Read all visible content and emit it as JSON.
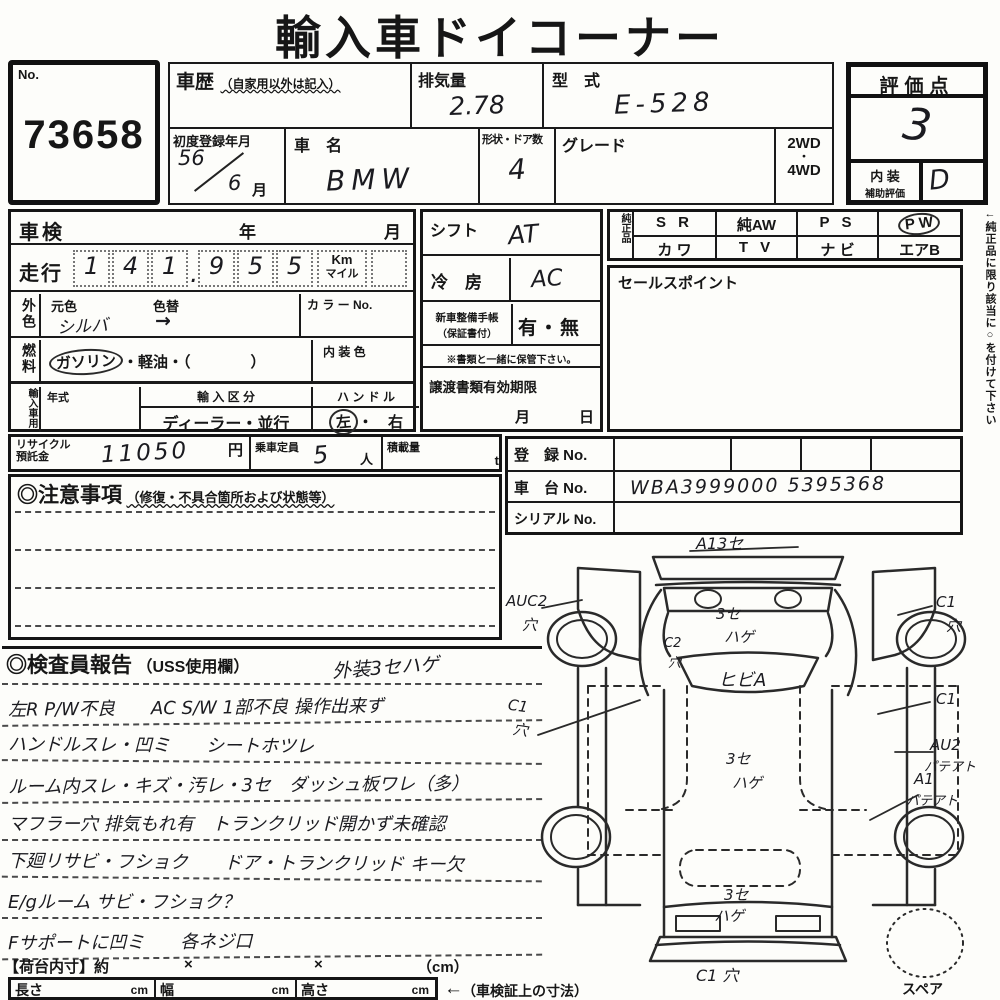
{
  "title": "輸入車ドイコーナー",
  "lot": {
    "label": "No.",
    "number": "73658"
  },
  "header": {
    "history_label": "車歴",
    "history_note": "（自家用以外は記入）",
    "displacement_label": "排気量",
    "displacement_value": "2.78",
    "model_label": "型　式",
    "model_value": "E-528",
    "first_reg_label": "初度登録年月",
    "first_reg_year": "56",
    "first_reg_month": "6",
    "first_reg_month_unit": "月",
    "make_label": "車　名",
    "make_value": "BMW",
    "body_doors_label": "形状・ドア数",
    "body_doors_value": "4",
    "grade_label": "グレード",
    "drive_top": "2WD",
    "drive_mid": "・",
    "drive_bottom": "4WD"
  },
  "rating": {
    "label": "評価点",
    "score": "3",
    "interior_line1": "内 装",
    "interior_line2": "補助評価",
    "interior_grade": "D"
  },
  "inspection": {
    "shaken_label": "車検",
    "year_label": "年",
    "month_label": "月",
    "mileage_label": "走行",
    "mileage_digits": [
      "1",
      "4",
      "1",
      "9",
      "5",
      "5"
    ],
    "mileage_point": ".",
    "unit_km": "Km",
    "unit_mile": "マイル",
    "ext_color_side": "外色",
    "orig_color_label": "元色",
    "color_change_label": "色替",
    "orig_color_value": "シルバ",
    "color_change_value": "→",
    "color_no_label": "カ ラ ー No.",
    "fuel_side": "燃料",
    "fuel_circled": "ガソリン",
    "fuel_rest": "・軽油・（　　　　）",
    "interior_color_label": "内 装 色"
  },
  "import_block": {
    "side_label": "輸入車用",
    "year_type_label": "年式",
    "class_label": "輸 入 区 分",
    "class_value": "ディーラー・並行",
    "handle_label": "ハ ン ド ル",
    "handle_left": "左",
    "handle_rest": "・　右"
  },
  "mid_block": {
    "shift_label": "シフト",
    "shift_value": "AT",
    "ac_label": "冷　房",
    "ac_value": "AC",
    "book_label1": "新車整備手帳",
    "book_label2": "（保証書付）",
    "book_value": "有・無",
    "book_note": "※書類と一緒に保管下さい。",
    "transfer_label": "譲渡書類有効期限",
    "transfer_month": "月",
    "transfer_day": "日"
  },
  "parts": {
    "side_label": "純正品",
    "row1": [
      "S R",
      "純AW",
      "P S",
      "P W"
    ],
    "row2": [
      "カ ワ",
      "T V",
      "ナ ビ",
      "エアB"
    ]
  },
  "sales": {
    "label": "セールスポイント"
  },
  "side_note": "←純正品に限り該当に○を付けて下さい",
  "recycle": {
    "label1": "リサイクル",
    "label2": "預託金",
    "value": "11050",
    "unit": "円",
    "capacity_label": "乗車定員",
    "capacity_value": "5",
    "capacity_unit": "人",
    "load_label": "積載量",
    "load_unit": "t"
  },
  "registration": {
    "reg_label": "登　録 No.",
    "chassis_label": "車　台 No.",
    "chassis_value": "WBA3999000 5395368",
    "serial_label": "シリアル No."
  },
  "cautions": {
    "title": "◎注意事項",
    "subtitle": "（修復・不具合箇所および状態等）"
  },
  "report": {
    "title": "◎検査員報告",
    "subtitle": "（USS使用欄）",
    "note": "外装3セハゲ",
    "lines": [
      "左R P/W不良　　AC S/W 1部不良 操作出来ず",
      "ハンドルスレ・凹ミ　　シートホツレ",
      "ルーム内スレ・キズ・汚レ・3セ　ダッシュ板ワレ（多）",
      "マフラー穴 排気もれ有　トランクリッド開かず未確認",
      "下廻リサビ・フショク　　ドア・トランクリッド キー欠",
      "E/gルーム サビ・フショク？",
      "Fサポートに凹ミ　　各ネジ口"
    ]
  },
  "cargo": {
    "label": "【荷台内寸】約",
    "x1": "×",
    "x2": "×",
    "unit": "（cm）",
    "length_label": "長さ",
    "width_label": "幅",
    "height_label": "高さ",
    "cm": "cm",
    "ref_arrow": "←",
    "ref_note": "（車検証上の寸法）",
    "spare_label": "スペア"
  },
  "diagram": {
    "annotations": [
      "A13セ",
      "AUC2",
      "穴",
      "C1",
      "穴",
      "C2",
      "穴",
      "3セ",
      "ハゲ",
      "ヒビA",
      "C1",
      "穴",
      "C1",
      "AU2",
      "パテアト",
      "3セ",
      "ハゲ",
      "A1",
      "パテアト",
      "3セ",
      "ハゲ",
      "C1 穴"
    ]
  }
}
